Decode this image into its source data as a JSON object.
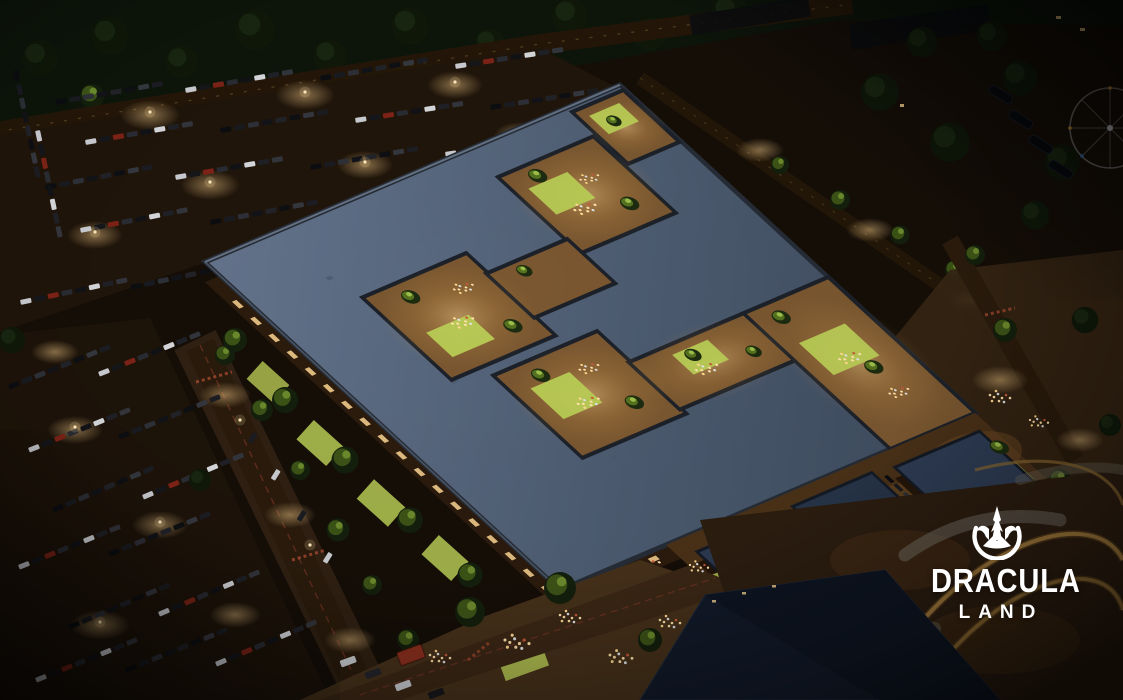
{
  "logo": {
    "title": "DRACULA",
    "subtitle": "LAND",
    "icon": "castle-emblem",
    "color": "#ffffff"
  },
  "scene": {
    "setting": "aerial-night-render",
    "landmarks": [
      "retail-park-building",
      "interior-courtyards",
      "parking-lot-northwest",
      "parking-lot-southwest",
      "tree-lined-street",
      "pedestrian-plaza",
      "roller-coaster-track",
      "ferris-wheel",
      "forest-edge"
    ]
  },
  "palette": {
    "night_ground": "#140d06",
    "roof_main": "#566779",
    "roof_block_navy": "#2b3950",
    "courtyard_floor": "#7a5730",
    "window_glow": "#ffd794",
    "lawn_green": "#b9cc55",
    "tree_lit": "#55721f",
    "tree_dark": "#0f1809",
    "coaster_track": "#a8803f",
    "road": "#241708",
    "crosswalk_red": "#a84a30",
    "light_pool": "#f0c887"
  }
}
